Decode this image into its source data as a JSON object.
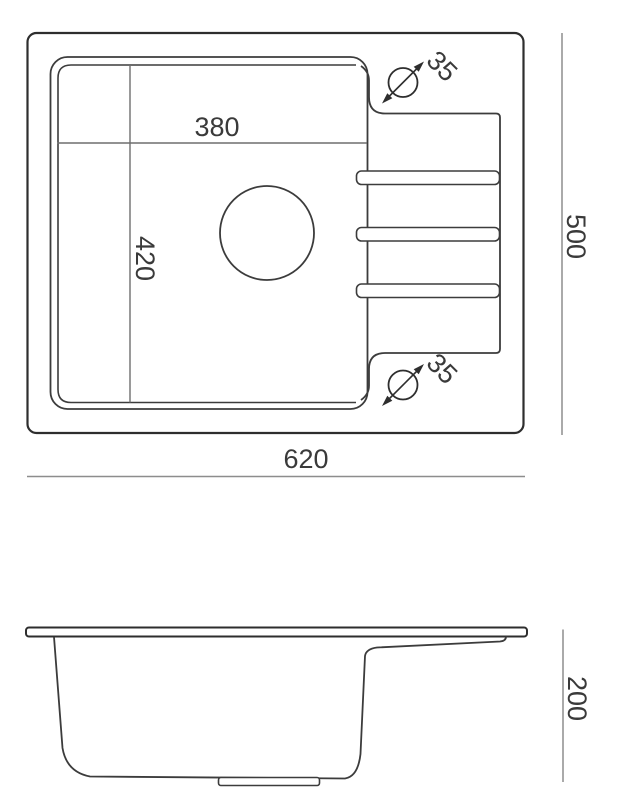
{
  "drawing": {
    "type": "technical-dimension-drawing",
    "subject": "kitchen sink with single bowl and drainboard",
    "views": [
      "top-view",
      "side-profile-view"
    ]
  },
  "colors": {
    "background": "#ffffff",
    "object_line": "#2e2e2e",
    "secondary_line": "#3c3c3c",
    "inner_dimension_line": "#6e6e6e",
    "outer_dimension_line": "#8d8d8d",
    "text": "#3a3a3a"
  },
  "labels": {
    "basin_width": "380",
    "basin_depth": "420",
    "overall_width": "620",
    "overall_depth": "500",
    "tap_hole_top": "35",
    "tap_hole_bottom": "35",
    "side_height": "200"
  },
  "icons": {
    "tap_hole_symbol": "diameter-circle-with-slash-arrows"
  }
}
